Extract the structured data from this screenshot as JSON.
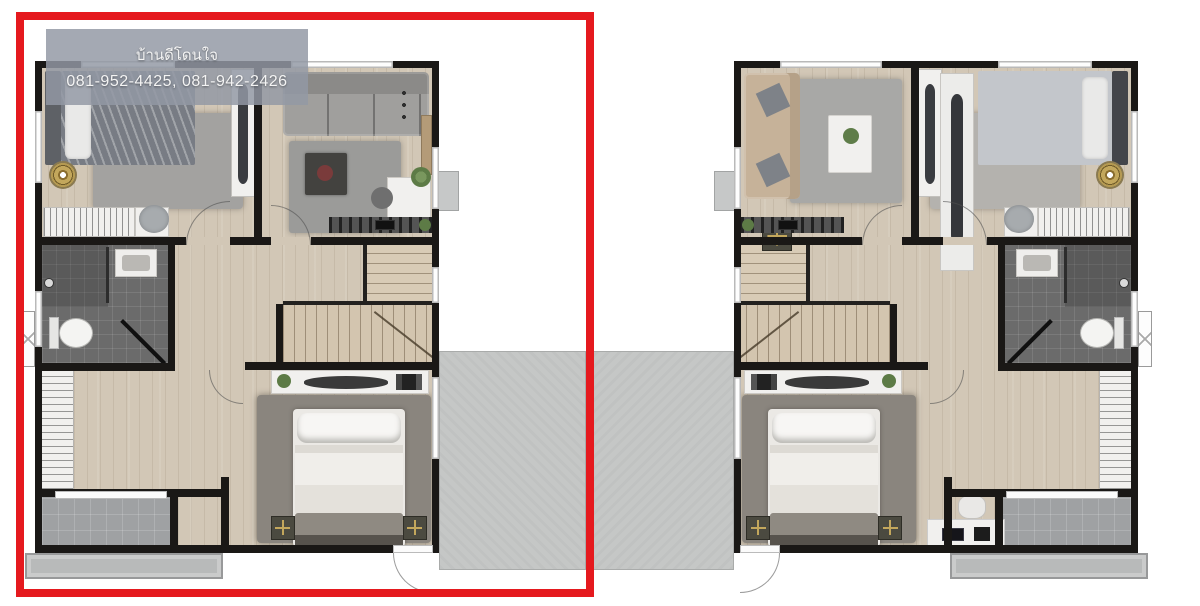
{
  "watermark": {
    "line1": "บ้านดีโดนใจ",
    "line2": "081-952-4425, 081-942-2426"
  },
  "units": [
    {
      "id": "left-unit",
      "highlighted": true
    },
    {
      "id": "right-unit",
      "highlighted": false
    }
  ],
  "colors": {
    "highlight-red": "#e5191e",
    "watermark-bg": "rgba(146,152,164,0.84)",
    "watermark-text": "#f4f4f4",
    "wall": "#1a1816",
    "wood-floor": "#d2c7b6",
    "bath-floor": "#6b6b6b",
    "terrace-concrete": "#c5c7c6",
    "balcony-tile": "#9fa1a3",
    "walkway-concrete": "#b8baba",
    "rug-dark": "#8a857e",
    "rug-light": "#a3a2a0",
    "sofa-gray": "#a09f9d",
    "sofa-beige": "#c6b299",
    "stair-wood": "#d3c5af",
    "gold-lamp": "#c3a75c",
    "plant-green": "#5d7b46",
    "furniture-white": "#f1f0ee"
  }
}
